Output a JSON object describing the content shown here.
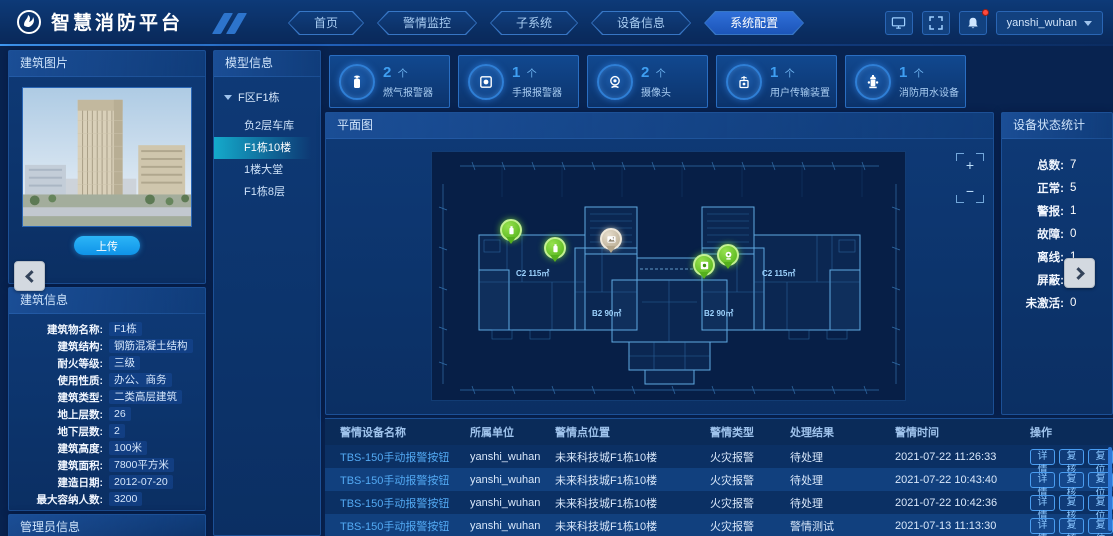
{
  "app": {
    "title": "智慧消防平台",
    "user": "yanshi_wuhan"
  },
  "nav": {
    "tabs": [
      {
        "label": "首页",
        "active": false
      },
      {
        "label": "警情监控",
        "active": false
      },
      {
        "label": "子系统",
        "active": false
      },
      {
        "label": "设备信息",
        "active": false
      },
      {
        "label": "系统配置",
        "active": true
      }
    ]
  },
  "photo_panel": {
    "title": "建筑图片",
    "upload_label": "上传"
  },
  "building_info": {
    "title": "建筑信息",
    "fields": [
      {
        "label": "建筑物名称:",
        "value": "F1栋"
      },
      {
        "label": "建筑结构:",
        "value": "钢筋混凝土结构"
      },
      {
        "label": "耐火等级:",
        "value": "三级"
      },
      {
        "label": "使用性质:",
        "value": "办公、商务"
      },
      {
        "label": "建筑类型:",
        "value": "二类高层建筑"
      },
      {
        "label": "地上层数:",
        "value": "26"
      },
      {
        "label": "地下层数:",
        "value": "2"
      },
      {
        "label": "建筑高度:",
        "value": "100米"
      },
      {
        "label": "建筑面积:",
        "value": "7800平方米"
      },
      {
        "label": "建造日期:",
        "value": "2012-07-20"
      },
      {
        "label": "最大容纳人数:",
        "value": "3200"
      }
    ]
  },
  "admin_panel": {
    "title": "管理员信息"
  },
  "model_panel": {
    "title": "模型信息",
    "root_label": "F区F1栋",
    "items": [
      {
        "label": "负2层车库",
        "selected": false
      },
      {
        "label": "F1栋10楼",
        "selected": true
      },
      {
        "label": "1楼大堂",
        "selected": false
      },
      {
        "label": "F1栋8层",
        "selected": false
      }
    ]
  },
  "stats": {
    "cards": [
      {
        "count": "2",
        "unit": "个",
        "label": "燃气报警器",
        "icon": "gas"
      },
      {
        "count": "1",
        "unit": "个",
        "label": "手报报警器",
        "icon": "manual"
      },
      {
        "count": "2",
        "unit": "个",
        "label": "摄像头",
        "icon": "camera"
      },
      {
        "count": "1",
        "unit": "个",
        "label": "用户传输装置",
        "icon": "transmission"
      },
      {
        "count": "1",
        "unit": "个",
        "label": "消防用水设备",
        "icon": "hydrant"
      }
    ]
  },
  "plan": {
    "title": "平面图",
    "zoom_in": "+",
    "zoom_out": "−",
    "units": [
      "C2 115㎡",
      "B2 90㎡",
      "B2 90㎡",
      "C2 115㎡"
    ],
    "markers": [
      {
        "type": "green",
        "icon": "gas",
        "x": 68,
        "y": 67
      },
      {
        "type": "green",
        "icon": "gas",
        "x": 112,
        "y": 85
      },
      {
        "type": "gray",
        "icon": "image",
        "x": 168,
        "y": 76
      },
      {
        "type": "green",
        "icon": "manual",
        "x": 261,
        "y": 102
      },
      {
        "type": "green",
        "icon": "camera",
        "x": 285,
        "y": 92
      }
    ]
  },
  "status_panel": {
    "title": "设备状态统计",
    "items": [
      {
        "label": "总数:",
        "value": "7"
      },
      {
        "label": "正常:",
        "value": "5"
      },
      {
        "label": "警报:",
        "value": "1"
      },
      {
        "label": "故障:",
        "value": "0"
      },
      {
        "label": "离线:",
        "value": "1"
      },
      {
        "label": "屏蔽:",
        "value": "0"
      },
      {
        "label": "未激活:",
        "value": "0"
      }
    ]
  },
  "table": {
    "headers": [
      "警情设备名称",
      "所属单位",
      "警情点位置",
      "警情类型",
      "处理结果",
      "警情时间",
      "操作"
    ],
    "actions": [
      "详情",
      "复核",
      "复位"
    ],
    "rows": [
      {
        "name": "TBS-150手动报警按钮",
        "unit": "yanshi_wuhan",
        "location": "未来科技城F1栋10楼",
        "type": "火灾报警",
        "result": "待处理",
        "time": "2021-07-22 11:26:33"
      },
      {
        "name": "TBS-150手动报警按钮",
        "unit": "yanshi_wuhan",
        "location": "未来科技城F1栋10楼",
        "type": "火灾报警",
        "result": "待处理",
        "time": "2021-07-22 10:43:40"
      },
      {
        "name": "TBS-150手动报警按钮",
        "unit": "yanshi_wuhan",
        "location": "未来科技城F1栋10楼",
        "type": "火灾报警",
        "result": "待处理",
        "time": "2021-07-22 10:42:36"
      },
      {
        "name": "TBS-150手动报警按钮",
        "unit": "yanshi_wuhan",
        "location": "未来科技城F1栋10楼",
        "type": "火灾报警",
        "result": "警情测试",
        "time": "2021-07-13 11:13:30"
      }
    ]
  }
}
